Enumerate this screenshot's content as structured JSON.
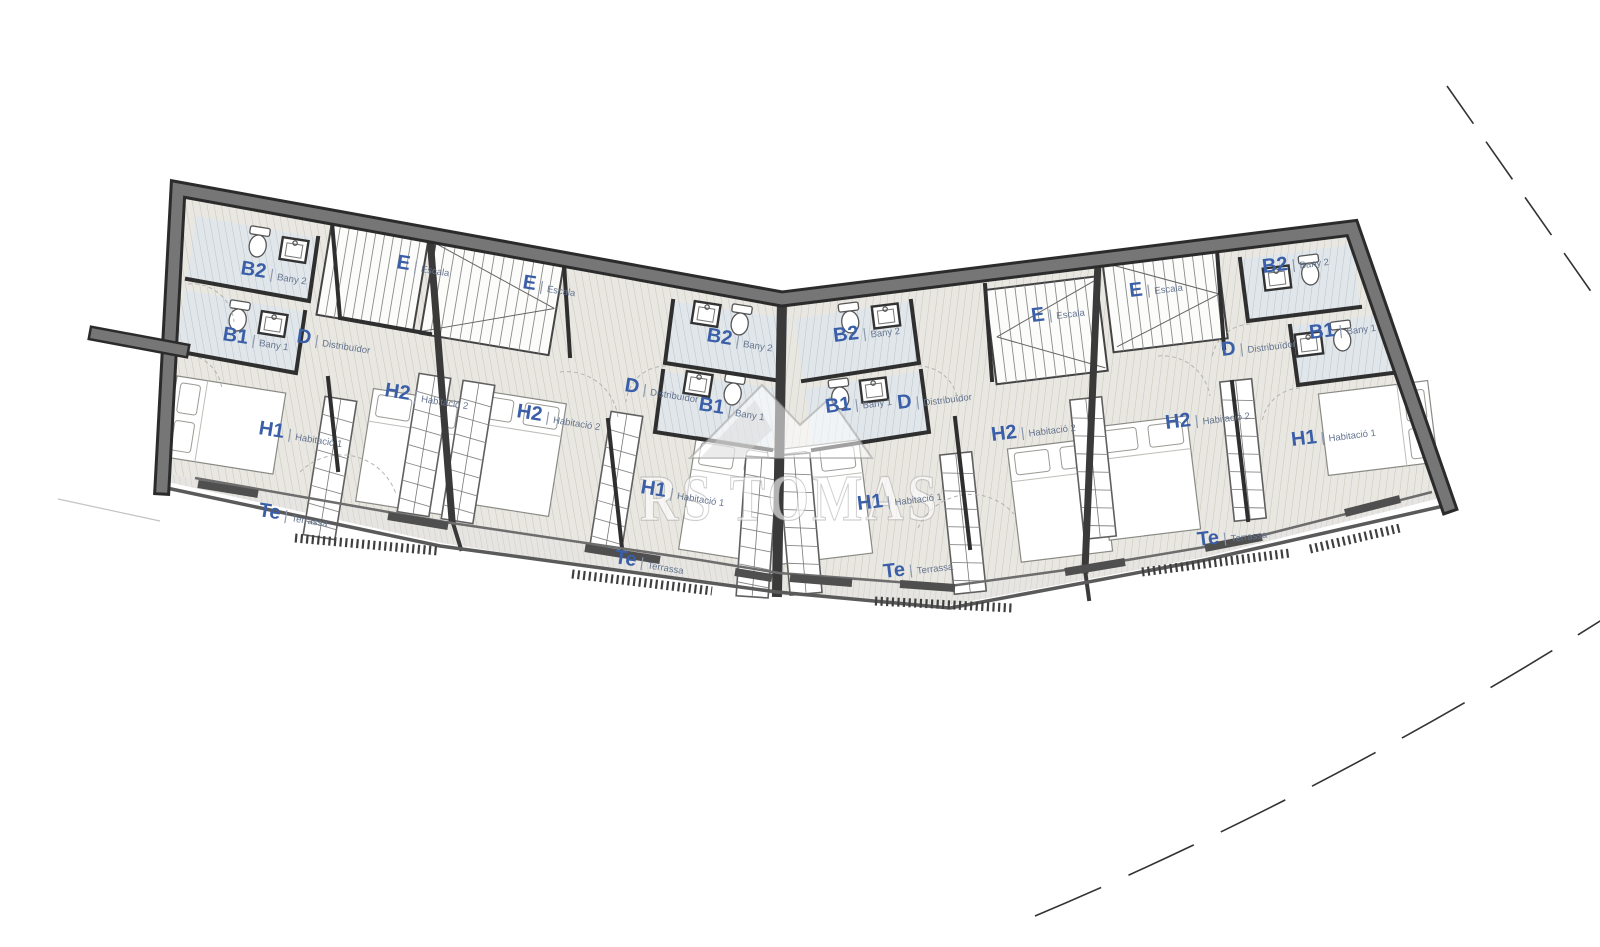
{
  "watermark": {
    "text": "RS TOMAS",
    "logo": "mountain-logo"
  },
  "units": [
    {
      "id": "1",
      "rooms": [
        {
          "abbr": "B2",
          "name": "Bany 2",
          "x": 240,
          "y": 274,
          "rot": 9
        },
        {
          "abbr": "B1",
          "name": "Bany 1",
          "x": 222,
          "y": 340,
          "rot": 9
        },
        {
          "abbr": "D",
          "name": "Distribuïdor",
          "x": 296,
          "y": 342,
          "rot": 9
        },
        {
          "abbr": "E",
          "name": "Escala",
          "x": 396,
          "y": 268,
          "rot": 9
        },
        {
          "abbr": "H2",
          "name": "Habitació 2",
          "x": 384,
          "y": 396,
          "rot": 9
        },
        {
          "abbr": "H1",
          "name": "Habitació 1",
          "x": 258,
          "y": 434,
          "rot": 9
        },
        {
          "abbr": "Te",
          "name": "Terrassa",
          "x": 258,
          "y": 516,
          "rot": 9
        }
      ]
    },
    {
      "id": "2",
      "rooms": [
        {
          "abbr": "E",
          "name": "Escala",
          "x": 522,
          "y": 288,
          "rot": 9
        },
        {
          "abbr": "B2",
          "name": "Bany 2",
          "x": 706,
          "y": 341,
          "rot": 9
        },
        {
          "abbr": "B1",
          "name": "Bany 1",
          "x": 698,
          "y": 410,
          "rot": 9
        },
        {
          "abbr": "D",
          "name": "Distribuïdor",
          "x": 624,
          "y": 391,
          "rot": 9
        },
        {
          "abbr": "H2",
          "name": "Habitació 2",
          "x": 516,
          "y": 417,
          "rot": 9
        },
        {
          "abbr": "H1",
          "name": "Habitació 1",
          "x": 640,
          "y": 493,
          "rot": 9
        },
        {
          "abbr": "Te",
          "name": "Terrassa",
          "x": 614,
          "y": 563,
          "rot": 9
        }
      ]
    },
    {
      "id": "3",
      "rooms": [
        {
          "abbr": "B2",
          "name": "Bany 2",
          "x": 834,
          "y": 342,
          "rot": -7
        },
        {
          "abbr": "B1",
          "name": "Bany 1",
          "x": 826,
          "y": 413,
          "rot": -7
        },
        {
          "abbr": "D",
          "name": "Distribuïdor",
          "x": 898,
          "y": 409,
          "rot": -7
        },
        {
          "abbr": "E",
          "name": "Escala",
          "x": 1032,
          "y": 322,
          "rot": -7
        },
        {
          "abbr": "H2",
          "name": "Habitació 2",
          "x": 992,
          "y": 441,
          "rot": -7
        },
        {
          "abbr": "H1",
          "name": "Habitació 1",
          "x": 858,
          "y": 510,
          "rot": -7
        },
        {
          "abbr": "Te",
          "name": "Terrassa",
          "x": 884,
          "y": 578,
          "rot": -7
        }
      ]
    },
    {
      "id": "4",
      "rooms": [
        {
          "abbr": "E",
          "name": "Escala",
          "x": 1130,
          "y": 297,
          "rot": -7
        },
        {
          "abbr": "B2",
          "name": "Bany 2",
          "x": 1263,
          "y": 273,
          "rot": -7
        },
        {
          "abbr": "B1",
          "name": "Bany 1",
          "x": 1310,
          "y": 339,
          "rot": -7
        },
        {
          "abbr": "D",
          "name": "Distribuïdor",
          "x": 1222,
          "y": 356,
          "rot": -7
        },
        {
          "abbr": "H2",
          "name": "Habitació 2",
          "x": 1166,
          "y": 429,
          "rot": -7
        },
        {
          "abbr": "H1",
          "name": "Habitació 1",
          "x": 1292,
          "y": 446,
          "rot": -7
        },
        {
          "abbr": "Te",
          "name": "Terrassa",
          "x": 1198,
          "y": 546,
          "rot": -7
        }
      ]
    }
  ],
  "colors": {
    "label_abbr": "#3a5fa8",
    "label_name": "#64748f",
    "wall": "#6f6f6f",
    "wall_edge": "#2b2b2b",
    "floor_tint": "#e9e7e1",
    "bath_tint": "#e1e6ea",
    "terrace_tint": "#e6e5e1"
  }
}
